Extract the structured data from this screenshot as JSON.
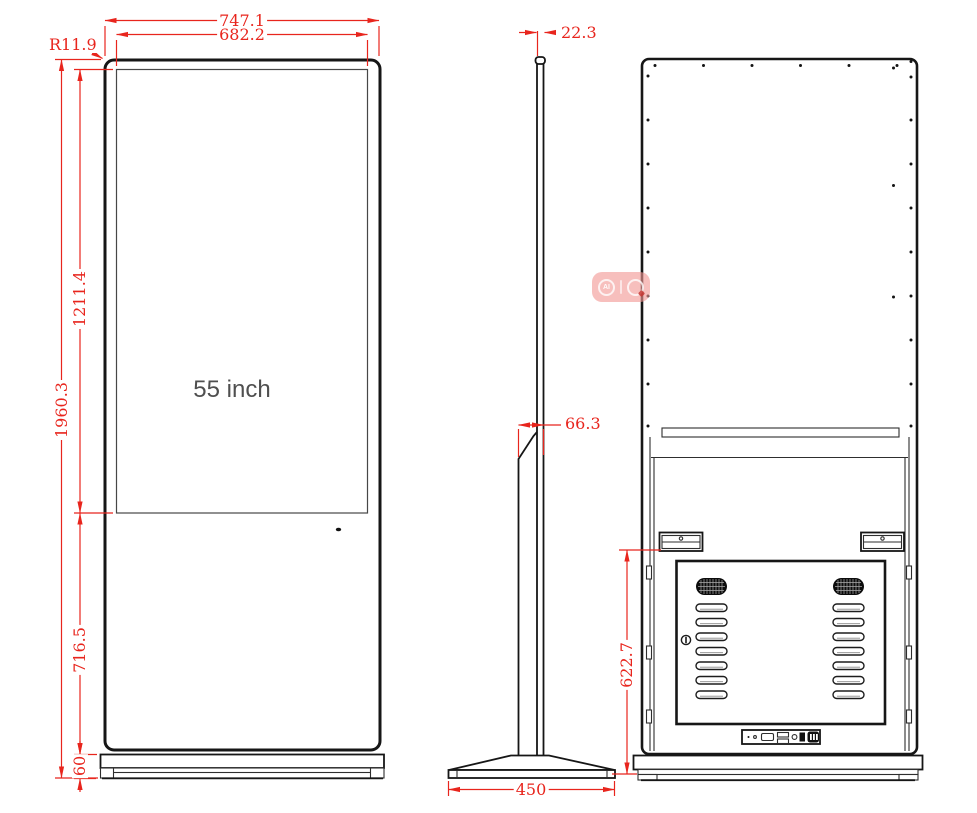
{
  "title": "55 inch floor-standing kiosk technical drawing",
  "colors": {
    "dimension": "#e8251d",
    "outline": "#161616",
    "background": "#ffffff"
  },
  "screen": {
    "label": "55 inch"
  },
  "dimensions": {
    "front_width_outer": "747.1",
    "front_width_screen": "682.2",
    "corner_radius": "R11.9",
    "total_height": "1960.3",
    "screen_height": "1211.4",
    "lower_height": "716.5",
    "base_height": "60",
    "side_thickness_top": "22.3",
    "side_depth": "66.3",
    "base_depth": "450",
    "back_door_height": "622.7"
  },
  "watermark": {
    "ai_label": "AI"
  }
}
